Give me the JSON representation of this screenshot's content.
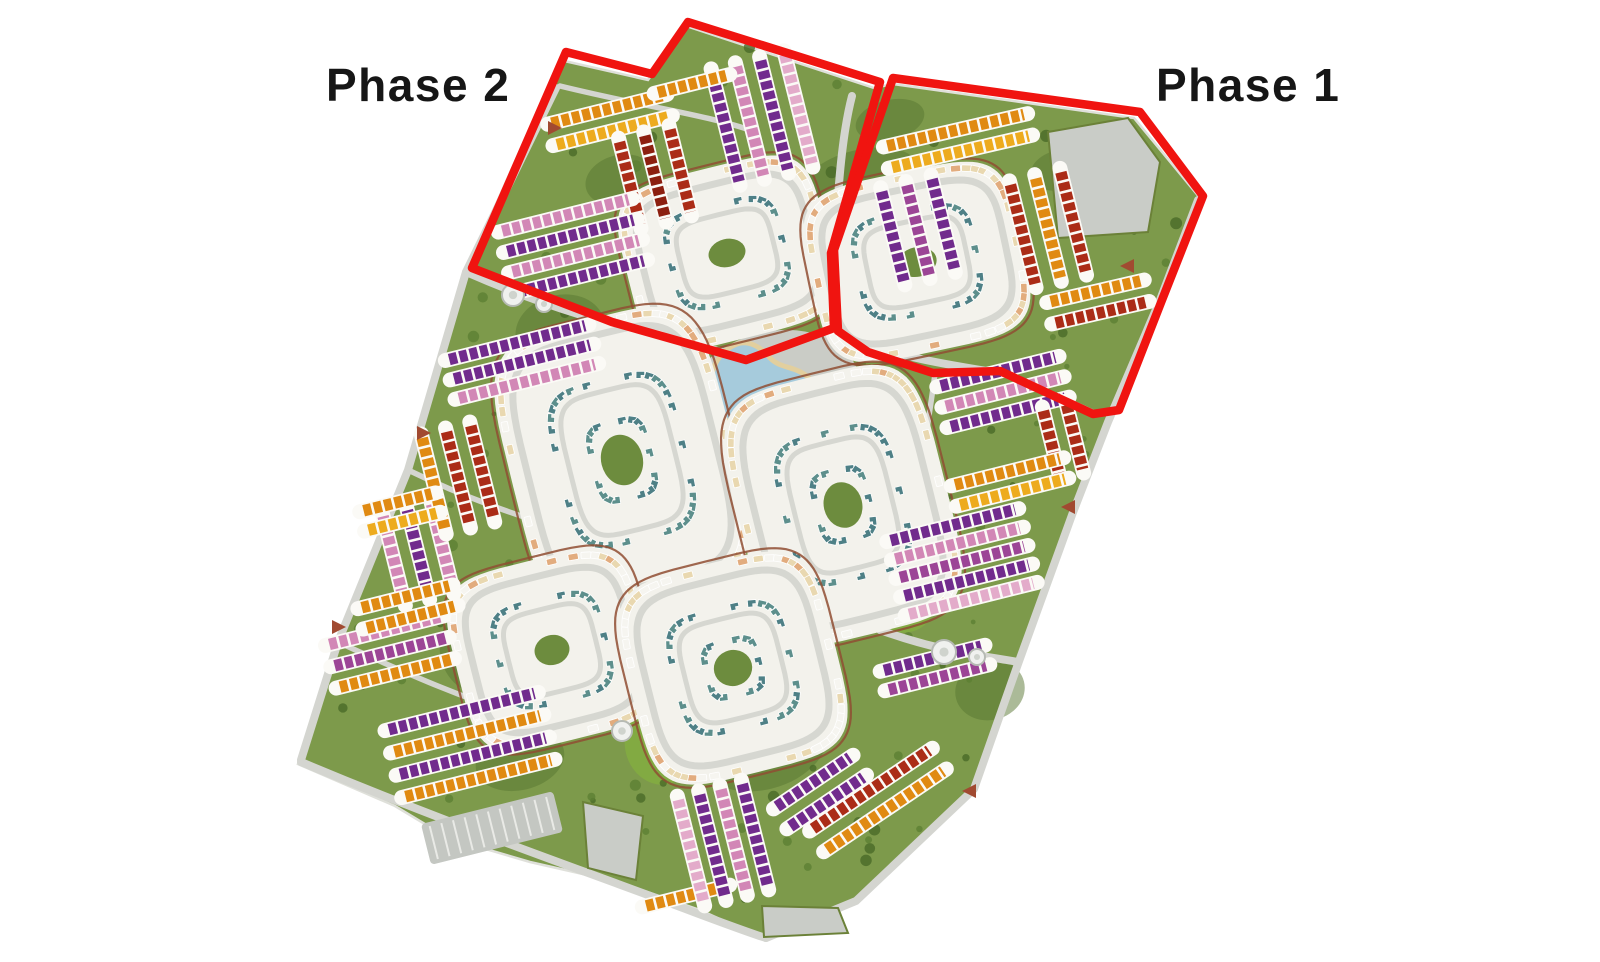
{
  "labels": {
    "phase2": {
      "text": "Phase 2",
      "x": 326,
      "y": 62
    },
    "phase1": {
      "text": "Phase 1",
      "x": 1156,
      "y": 62
    }
  },
  "boundary": {
    "color": "#f01410",
    "width": 8.5,
    "phase2_path": "M566,52 L652,74 L688,22 L880,82 L831,253 L834,328 L746,360 L612,322 L472,268 Z",
    "phase1_path": "M893,78 L1140,112 L1203,196 L1162,300 L1119,410 L1093,414 L1000,371 L933,373 L868,352 L838,331 L834,250 Z"
  },
  "palette": {
    "orange": "#e08a12",
    "gold": "#edab1e",
    "red": "#ab2c17",
    "maroon": "#8c1f10",
    "purple": "#712b8d",
    "magenta": "#9c4596",
    "pink": "#d287b6",
    "pinkLight": "#e3abca",
    "cream": "#e9d8b0",
    "peach": "#e2ac7e",
    "sage": "#e3e7d4",
    "teal": "#4e8086",
    "teal2": "#5d8f8c",
    "white": "#f6f5f0"
  },
  "site": {
    "fill": "#7d9a4b",
    "edge": "#dfe0da",
    "dark_green": "#587631",
    "bright_green": "#85b13f",
    "tree_colors": [
      "#4a6a28",
      "#5d8033"
    ],
    "points": [
      [
        560,
        60
      ],
      [
        648,
        80
      ],
      [
        686,
        26
      ],
      [
        874,
        88
      ],
      [
        893,
        84
      ],
      [
        1134,
        118
      ],
      [
        1200,
        198
      ],
      [
        1160,
        300
      ],
      [
        1108,
        422
      ],
      [
        1072,
        515
      ],
      [
        1018,
        664
      ],
      [
        974,
        790
      ],
      [
        856,
        903
      ],
      [
        766,
        940
      ],
      [
        700,
        910
      ],
      [
        618,
        882
      ],
      [
        530,
        862
      ],
      [
        448,
        838
      ],
      [
        395,
        806
      ],
      [
        298,
        764
      ],
      [
        338,
        642
      ],
      [
        408,
        470
      ],
      [
        466,
        272
      ]
    ],
    "dark_patches": [
      [
        700,
        420,
        150,
        120
      ],
      [
        640,
        600,
        120,
        150
      ],
      [
        760,
        740,
        140,
        100
      ],
      [
        560,
        330,
        90,
        70
      ],
      [
        860,
        180,
        120,
        60
      ],
      [
        480,
        650,
        80,
        90
      ],
      [
        900,
        560,
        90,
        90
      ],
      [
        990,
        690,
        70,
        60
      ],
      [
        620,
        180,
        70,
        50
      ],
      [
        1060,
        170,
        60,
        40
      ],
      [
        520,
        760,
        90,
        60
      ],
      [
        890,
        120,
        70,
        40
      ]
    ],
    "bright_patches": [
      [
        745,
        480,
        55,
        110
      ],
      [
        700,
        600,
        60,
        90
      ],
      [
        660,
        745,
        70,
        80
      ],
      [
        905,
        605,
        60,
        55
      ],
      [
        840,
        350,
        45,
        32
      ],
      [
        585,
        560,
        40,
        60
      ]
    ]
  },
  "roads": {
    "color": "#d4d5d0",
    "main": [
      "M556,88 L466,272 L408,470 L338,642 L301,760",
      "M301,762 C420,812 520,848 618,884 C700,914 740,930 766,938",
      "M766,938 L856,901 L974,789",
      "M974,789 L1018,664 L1072,515 L1108,422 L1160,300 L1198,200",
      "M466,272 C580,322 650,332 706,348 C770,366 806,344 833,334",
      "M852,96 C838,150 834,240 834,334",
      "M834,334 C900,358 955,366 1006,374 L1094,414",
      "M880,630 C940,652 985,656 1018,662"
    ],
    "minor": [
      "M408,470 C470,500 520,516 558,528",
      "M338,642 C420,680 470,700 520,716",
      "M560,86 C650,108 704,114 756,132",
      "M935,374 C926,440 918,486 908,530"
    ]
  },
  "plots": {
    "fill": "#c9ccc7",
    "edge": "#6b8138",
    "polys": [
      [
        [
          1048,
          132
        ],
        [
          1128,
          118
        ],
        [
          1160,
          162
        ],
        [
          1148,
          232
        ],
        [
          1058,
          238
        ]
      ],
      [
        [
          583,
          802
        ],
        [
          643,
          816
        ],
        [
          636,
          880
        ],
        [
          588,
          868
        ]
      ],
      [
        [
          762,
          906
        ],
        [
          838,
          908
        ],
        [
          848,
          933
        ],
        [
          764,
          937
        ]
      ]
    ]
  },
  "parking": {
    "cx": 492,
    "cy": 828,
    "w": 136,
    "h": 42,
    "angle": -14
  },
  "water": {
    "fill": "#a6cbdc",
    "beach": "#e2cf9e",
    "sand": "#dfc894",
    "plaza": {
      "cx": 772,
      "cy": 398,
      "rx": 90,
      "ry": 66,
      "angle": -16
    },
    "lagoon_path": "M737,344 C716,352 708,374 712,394 C716,416 732,430 752,428 C764,427 770,420 782,424 C798,430 812,422 816,406 C820,390 812,376 796,370 C786,366 778,366 770,358 C760,346 748,340 737,344 Z",
    "ponds": [
      [
        754,
        464,
        13,
        9
      ],
      [
        720,
        554,
        12,
        8
      ]
    ],
    "sand_spots": [
      [
        745,
        500,
        10,
        7
      ],
      [
        737,
        531,
        8,
        6
      ],
      [
        702,
        476,
        9,
        6
      ]
    ]
  },
  "loops": [
    {
      "cx": 727,
      "cy": 253,
      "w": 170,
      "h": 140,
      "angle": -14
    },
    {
      "cx": 917,
      "cy": 262,
      "w": 180,
      "h": 148,
      "angle": -12
    },
    {
      "cx": 622,
      "cy": 460,
      "w": 190,
      "h": 255,
      "angle": -14
    },
    {
      "cx": 843,
      "cy": 505,
      "w": 175,
      "h": 230,
      "angle": -14
    },
    {
      "cx": 552,
      "cy": 650,
      "w": 160,
      "h": 150,
      "angle": -14
    },
    {
      "cx": 733,
      "cy": 668,
      "w": 175,
      "h": 180,
      "angle": -14
    }
  ],
  "loop_style": {
    "road": "#d6d7d1",
    "trail": "#8f4e33",
    "base": "#f3f2ec",
    "court": "#6d8c3e",
    "ring_colors": [
      "white",
      "cream",
      "cream",
      "white",
      "peach"
    ],
    "inner_colors": [
      "teal",
      "teal2"
    ]
  },
  "blocks": [
    {
      "cx": 610,
      "cy": 120,
      "a": -14,
      "len": 115,
      "pitch": 22,
      "rows": [
        "orange",
        "gold"
      ]
    },
    {
      "cx": 655,
      "cy": 177,
      "a": 76,
      "len": 85,
      "pitch": 26,
      "rows": [
        "red",
        "maroon",
        "red"
      ]
    },
    {
      "cx": 573,
      "cy": 246,
      "a": -14,
      "len": 130,
      "pitch": 21,
      "rows": [
        "pink",
        "purple",
        "pink",
        "purple"
      ]
    },
    {
      "cx": 762,
      "cy": 118,
      "a": 76,
      "len": 112,
      "pitch": 25,
      "rows": [
        "pinkLight",
        "purple",
        "pink",
        "purple"
      ]
    },
    {
      "cx": 692,
      "cy": 84,
      "a": -14,
      "len": 70,
      "pitch": 18,
      "rows": [
        "orange"
      ]
    },
    {
      "cx": 958,
      "cy": 141,
      "a": -13,
      "len": 140,
      "pitch": 22,
      "rows": [
        "orange",
        "gold"
      ]
    },
    {
      "cx": 918,
      "cy": 230,
      "a": 76,
      "len": 92,
      "pitch": 26,
      "rows": [
        "purple",
        "magenta",
        "purple"
      ]
    },
    {
      "cx": 1048,
      "cy": 228,
      "a": 76,
      "len": 102,
      "pitch": 26,
      "rows": [
        "red",
        "orange",
        "red"
      ]
    },
    {
      "cx": 1098,
      "cy": 302,
      "a": -13,
      "len": 92,
      "pitch": 22,
      "rows": [
        "orange",
        "red"
      ]
    },
    {
      "cx": 1003,
      "cy": 392,
      "a": -14,
      "len": 118,
      "pitch": 21,
      "rows": [
        "purple",
        "pink",
        "purple"
      ]
    },
    {
      "cx": 1063,
      "cy": 440,
      "a": 76,
      "len": 66,
      "pitch": 24,
      "rows": [
        "red",
        "red"
      ]
    },
    {
      "cx": 1010,
      "cy": 482,
      "a": -14,
      "len": 108,
      "pitch": 21,
      "rows": [
        "orange",
        "gold"
      ]
    },
    {
      "cx": 962,
      "cy": 562,
      "a": -14,
      "len": 128,
      "pitch": 19,
      "rows": [
        "purple",
        "pink",
        "magenta",
        "purple",
        "pinkLight"
      ]
    },
    {
      "cx": 935,
      "cy": 668,
      "a": -14,
      "len": 100,
      "pitch": 20,
      "rows": [
        "purple",
        "magenta"
      ]
    },
    {
      "cx": 878,
      "cy": 800,
      "a": -34,
      "len": 140,
      "pitch": 25,
      "rows": [
        "red",
        "orange"
      ]
    },
    {
      "cx": 820,
      "cy": 792,
      "a": -34,
      "len": 88,
      "pitch": 24,
      "rows": [
        "purple",
        "purple"
      ]
    },
    {
      "cx": 686,
      "cy": 896,
      "a": -14,
      "len": 82,
      "pitch": 20,
      "rows": [
        "orange"
      ]
    },
    {
      "cx": 723,
      "cy": 843,
      "a": 76,
      "len": 105,
      "pitch": 22,
      "rows": [
        "purple",
        "pink",
        "purple",
        "pinkLight"
      ]
    },
    {
      "cx": 470,
      "cy": 745,
      "a": -14,
      "len": 150,
      "pitch": 23,
      "rows": [
        "purple",
        "orange",
        "purple",
        "orange"
      ]
    },
    {
      "cx": 390,
      "cy": 652,
      "a": -14,
      "len": 114,
      "pitch": 22,
      "rows": [
        "pink",
        "magenta",
        "orange"
      ]
    },
    {
      "cx": 418,
      "cy": 553,
      "a": 76,
      "len": 88,
      "pitch": 25,
      "rows": [
        "pink",
        "purple",
        "pink"
      ]
    },
    {
      "cx": 458,
      "cy": 478,
      "a": 76,
      "len": 95,
      "pitch": 25,
      "rows": [
        "red",
        "red",
        "orange"
      ]
    },
    {
      "cx": 400,
      "cy": 512,
      "a": -14,
      "len": 70,
      "pitch": 20,
      "rows": [
        "orange",
        "gold"
      ]
    },
    {
      "cx": 408,
      "cy": 607,
      "a": -14,
      "len": 90,
      "pitch": 21,
      "rows": [
        "orange",
        "orange"
      ]
    },
    {
      "cx": 522,
      "cy": 362,
      "a": -14,
      "len": 140,
      "pitch": 20,
      "rows": [
        "purple",
        "purple",
        "pink"
      ]
    }
  ],
  "circles": [
    [
      513,
      295,
      11
    ],
    [
      544,
      304,
      8
    ],
    [
      622,
      731,
      10
    ],
    [
      944,
      652,
      12
    ],
    [
      977,
      657,
      8
    ]
  ],
  "arrows": {
    "color": "#a14a31",
    "positions": [
      [
        548,
        128,
        0
      ],
      [
        417,
        433,
        0
      ],
      [
        332,
        627,
        0
      ],
      [
        1134,
        266,
        180
      ],
      [
        1075,
        507,
        180
      ],
      [
        976,
        791,
        180
      ]
    ]
  }
}
